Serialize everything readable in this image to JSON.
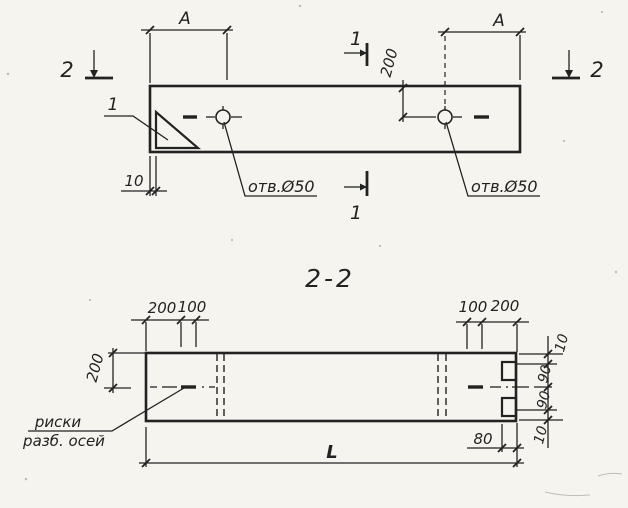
{
  "colors": {
    "paper": "#f5f4ef",
    "ink": "#222222"
  },
  "plan": {
    "section_cut_2_left": "2",
    "section_cut_2_right": "2",
    "section_cut_1_top": "1",
    "section_cut_1_bottom": "1",
    "corner_mark_callout": "1",
    "dim_a_left": "A",
    "dim_a_right": "A",
    "dim_hole_offset": "200",
    "dim_corner_mark_offset": "10",
    "hole_label_left": "отв.Ø50",
    "hole_label_right": "отв.Ø50"
  },
  "section": {
    "title": "2-2",
    "dim_top_left_200": "200",
    "dim_top_left_100": "100",
    "dim_top_right_100": "100",
    "dim_top_right_200": "200",
    "dim_left_200": "200",
    "dim_right_10_top": "10",
    "dim_right_90_top": "90",
    "dim_right_90_bottom": "90",
    "dim_right_10_bottom": "10",
    "dim_notch_80": "80",
    "dim_length": "L",
    "axis_marks_label_line1": "риски",
    "axis_marks_label_line2": "разб. осей"
  }
}
